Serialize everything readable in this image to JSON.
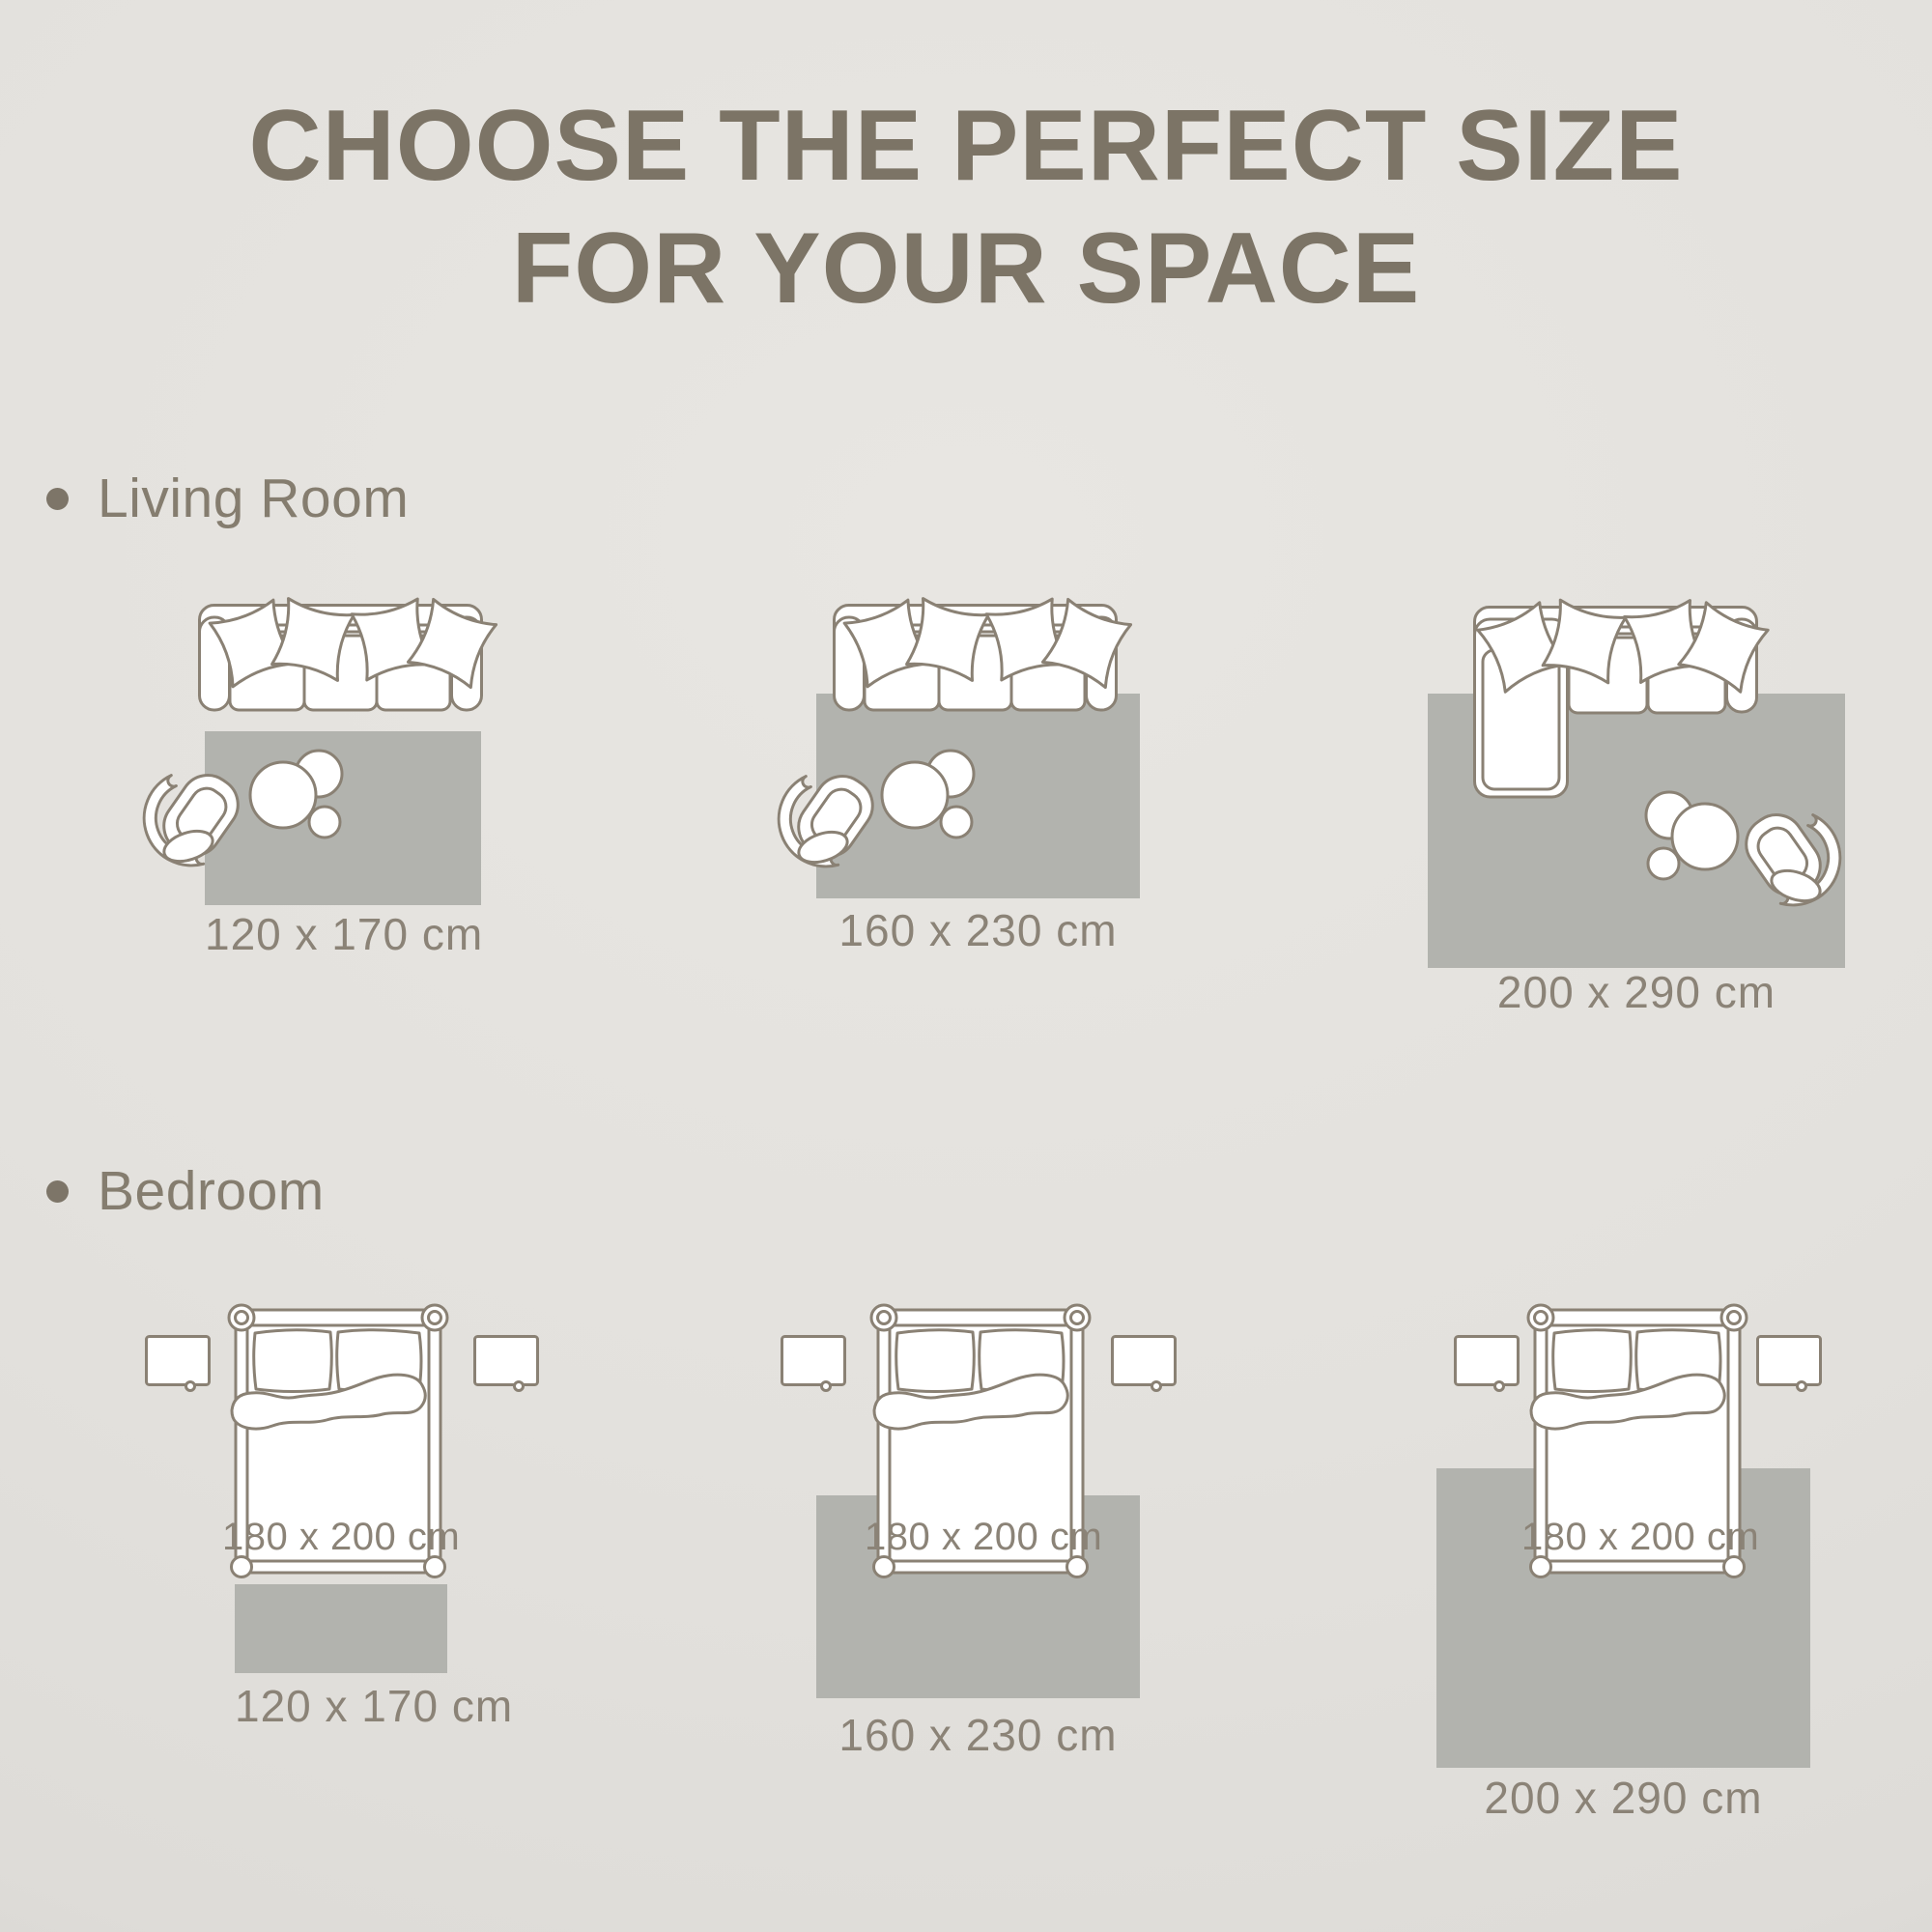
{
  "title": {
    "line1": "CHOOSE THE PERFECT SIZE",
    "line2": "FOR YOUR SPACE"
  },
  "sections": [
    {
      "label": "Living Room",
      "layouts": [
        {
          "rug_size": "120 x 170 cm"
        },
        {
          "rug_size": "160 x 230 cm"
        },
        {
          "rug_size": "200 x 290 cm"
        }
      ]
    },
    {
      "label": "Bedroom",
      "bed_size": "180 x 200 cm",
      "layouts": [
        {
          "rug_size": "120 x 170 cm"
        },
        {
          "rug_size": "160 x 230 cm"
        },
        {
          "rug_size": "200 x 290 cm"
        }
      ]
    }
  ],
  "colors": {
    "background": "#e3e1dd",
    "rug": "#b2b3ae",
    "furniture_outline": "#8a8174",
    "title_text": "#7c7466",
    "section_text": "#857d6f",
    "label_text": "#8b8377",
    "bullet": "#7d7568"
  },
  "icons": {
    "bullet": "filled-circle",
    "sofa": "three-seat-sofa-top-view",
    "sectional_sofa": "l-shaped-corner-sofa-top-view",
    "coffee_table": "round-nesting-tables-top-view",
    "armchair": "swivel-armchair-top-view",
    "bed": "double-bed-top-view",
    "nightstand": "nightstand-top-view"
  }
}
